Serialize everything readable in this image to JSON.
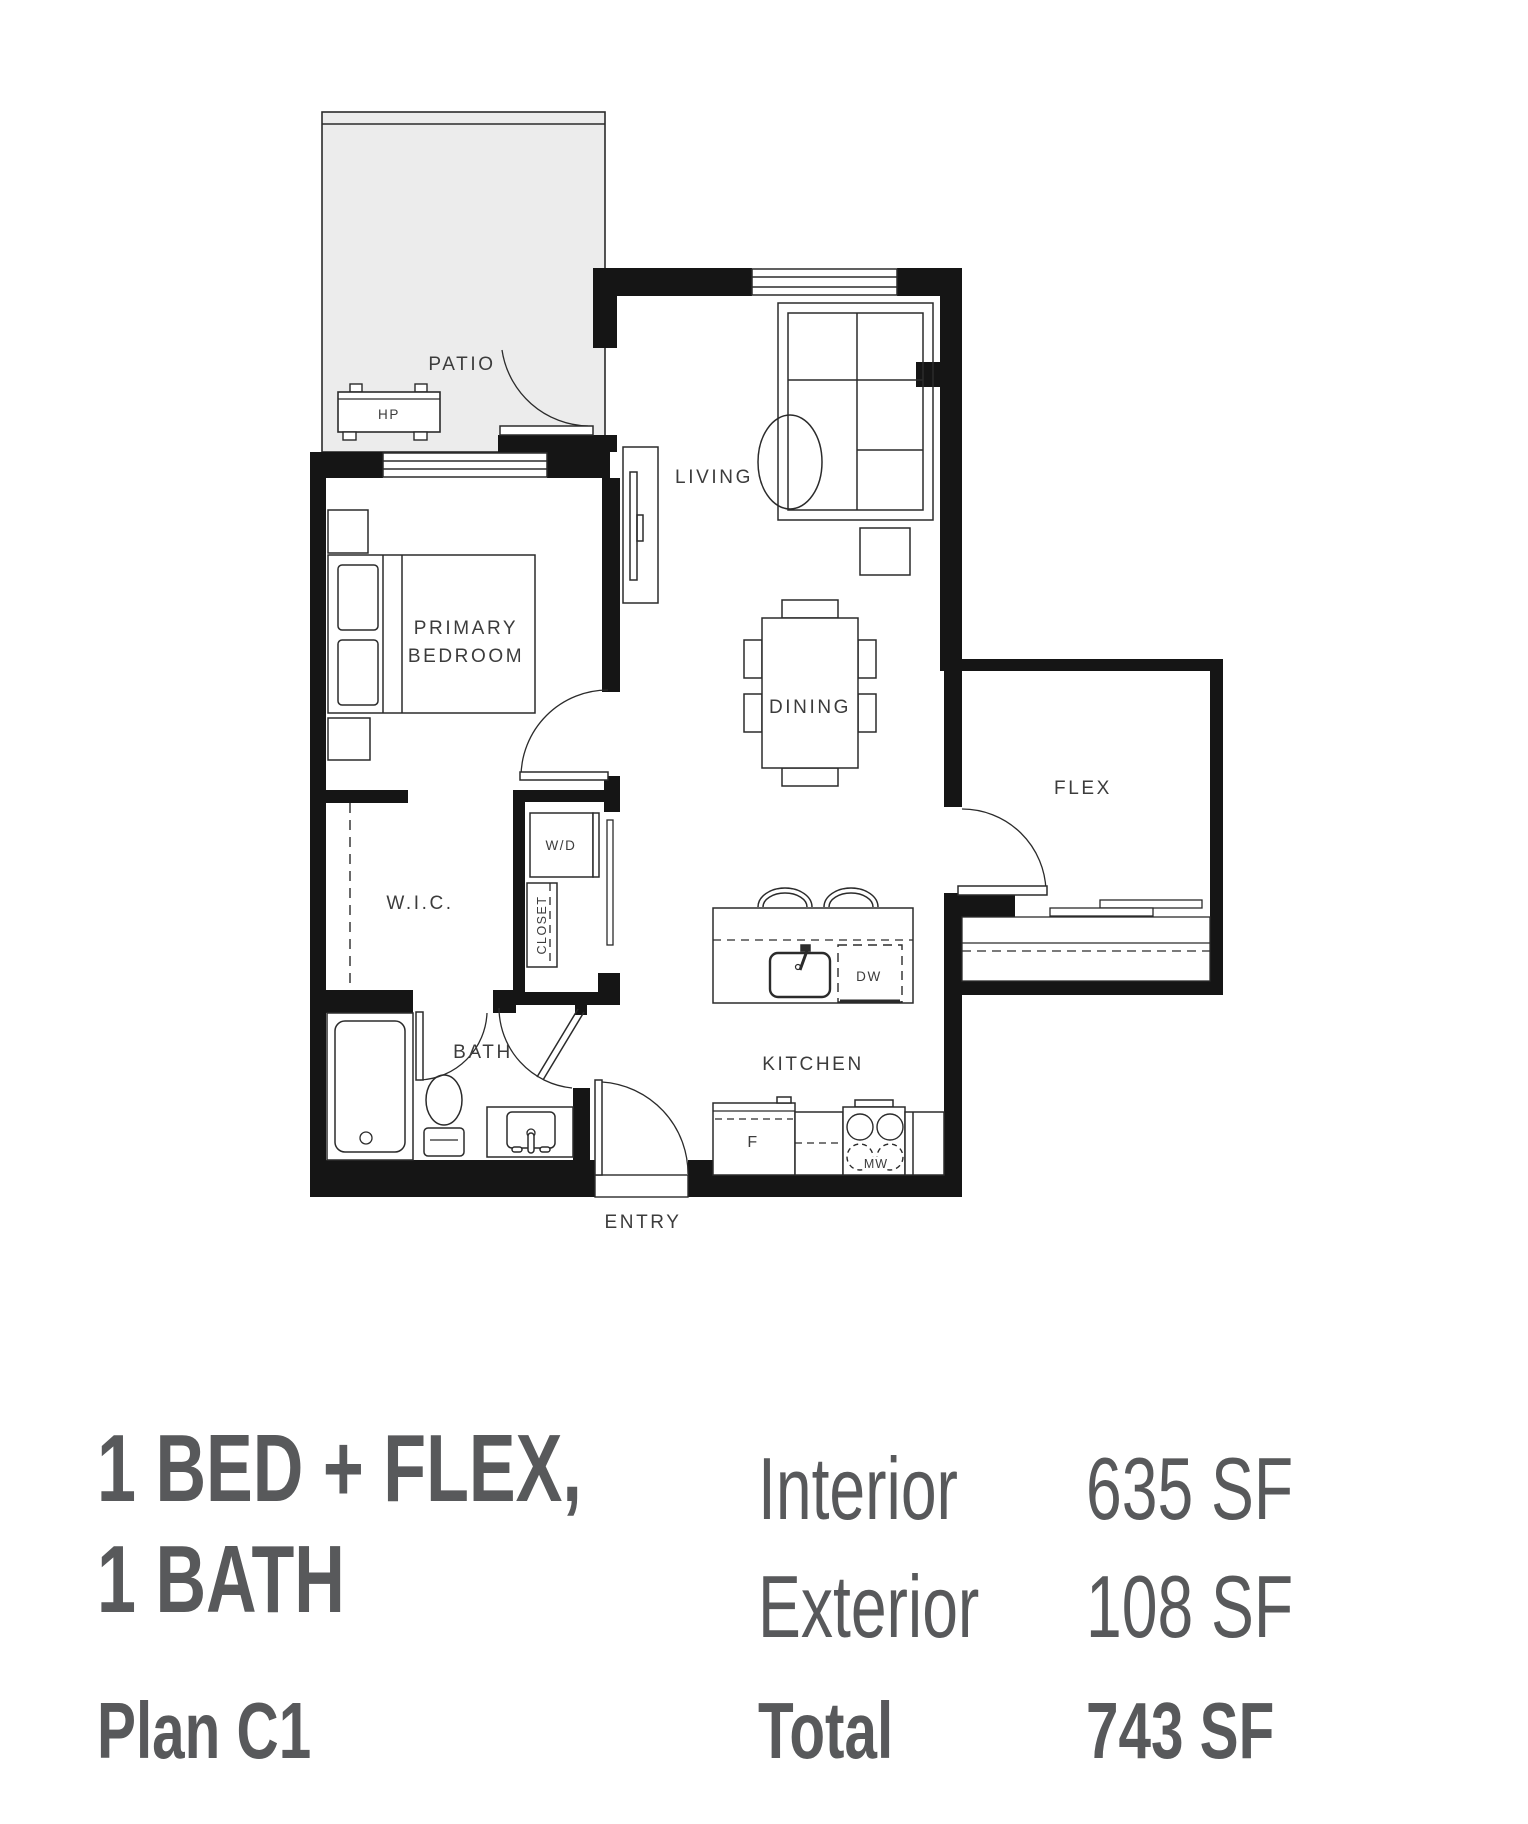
{
  "colors": {
    "background": "#ffffff",
    "wall": "#151515",
    "line": "#2b2b2b",
    "patio_fill": "#ececec",
    "plan_text": "#3c3c3c",
    "summary_text": "#58595b"
  },
  "plan": {
    "rooms": {
      "patio": "PATIO",
      "living": "LIVING",
      "primary_line1": "PRIMARY",
      "primary_line2": "BEDROOM",
      "dining": "DINING",
      "flex": "FLEX",
      "wic": "W.I.C.",
      "bath": "BATH",
      "kitchen": "KITCHEN",
      "entry": "ENTRY"
    },
    "fixtures": {
      "heat_pump": "HP",
      "washer_dryer": "W/D",
      "closet": "CLOSET",
      "dishwasher": "DW",
      "fridge": "F",
      "microwave": "MW"
    }
  },
  "summary": {
    "title_line1": "1 BED + FLEX,",
    "title_line2": "1 BATH",
    "plan_label": "Plan C1",
    "rows": [
      {
        "label": "Interior",
        "value": "635 SF"
      },
      {
        "label": "Exterior",
        "value": "108 SF"
      }
    ],
    "total_label": "Total",
    "total_value": "743 SF"
  }
}
